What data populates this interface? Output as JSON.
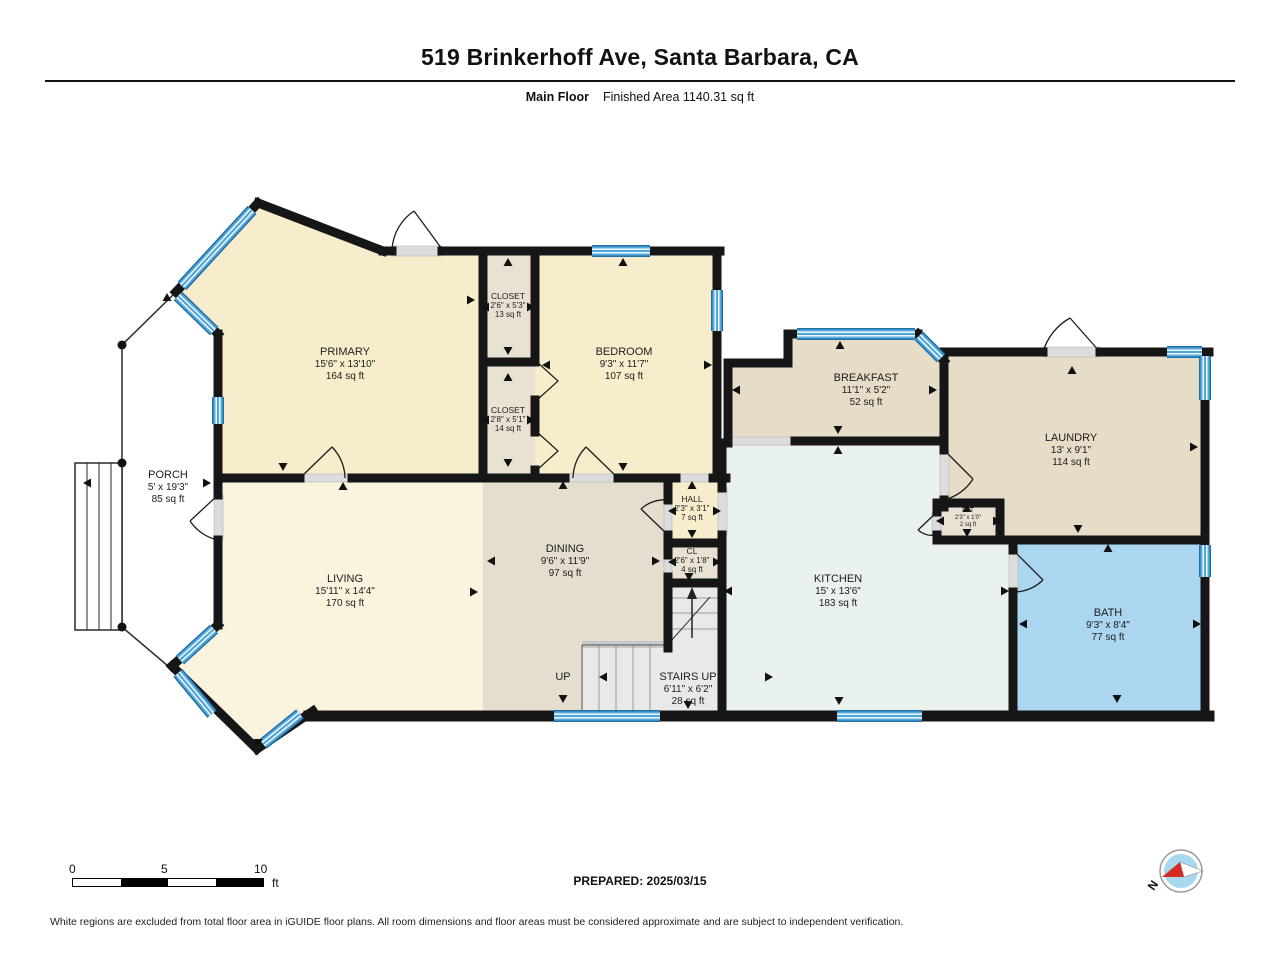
{
  "header": {
    "title": "519 Brinkerhoff Ave, Santa Barbara, CA",
    "floor_label": "Main Floor",
    "area_label": "Finished Area 1140.31 sq ft"
  },
  "rooms": {
    "primary": {
      "name": "PRIMARY",
      "dims": "15'6\" x 13'10\"",
      "area": "164 sq ft"
    },
    "closet1": {
      "name": "CLOSET",
      "dims": "2'6\" x 5'3\"",
      "area": "13 sq ft"
    },
    "closet2": {
      "name": "CLOSET",
      "dims": "2'8\" x 5'1\"",
      "area": "14 sq ft"
    },
    "bedroom": {
      "name": "BEDROOM",
      "dims": "9'3\" x 11'7\"",
      "area": "107 sq ft"
    },
    "breakfast": {
      "name": "BREAKFAST",
      "dims": "11'1\" x 5'2\"",
      "area": "52 sq ft"
    },
    "laundry": {
      "name": "LAUNDRY",
      "dims": "13' x 9'1\"",
      "area": "114 sq ft"
    },
    "porch": {
      "name": "PORCH",
      "dims": "5' x 19'3\"",
      "area": "85 sq ft"
    },
    "living": {
      "name": "LIVING",
      "dims": "15'11\" x 14'4\"",
      "area": "170 sq ft"
    },
    "dining": {
      "name": "DINING",
      "dims": "9'6\" x 11'9\"",
      "area": "97 sq ft"
    },
    "hall": {
      "name": "HALL",
      "dims": "2'3\" x 3'1\"",
      "area": "7 sq ft"
    },
    "cl": {
      "name": "CL",
      "dims": "2'6\" x 1'8\"",
      "area": "4 sq ft"
    },
    "kitchen": {
      "name": "KITCHEN",
      "dims": "15' x 13'6\"",
      "area": "183 sq ft"
    },
    "bath": {
      "name": "BATH",
      "dims": "9'3\" x 8'4\"",
      "area": "77 sq ft"
    },
    "stairs": {
      "name": "STAIRS UP",
      "dims": "6'11\" x 6'2\"",
      "area": "28 sq ft"
    },
    "pat": {
      "name": "PAT",
      "dims": "2'3\" x 1'0\"",
      "area": "2 sq ft"
    },
    "up_label": "UP"
  },
  "scale_bar": {
    "tick0": "0",
    "tick5": "5",
    "tick10": "10",
    "unit": "ft"
  },
  "footer": {
    "prepared": "PREPARED: 2025/03/15",
    "disclaimer": "White regions are excluded from total floor area in iGUIDE floor plans. All room dimensions and floor areas must be considered approximate and are subject to independent verification."
  },
  "compass": {
    "north_label": "N"
  },
  "colors": {
    "wall": "#161616",
    "window_blue": "#4ea6da",
    "cream": "#f7edcc",
    "living_cream": "#faf3dd",
    "dining_tan": "#e5decf",
    "tan": "#e7dcc7",
    "kitchen_mint": "#e9f2ec",
    "bath_blue": "#abd6ef",
    "closet_gray": "#e9e2d3",
    "stairs_gray": "#e9e9e9",
    "porch_white": "#ffffff",
    "compass_blue": "#a8d8f0",
    "compass_red": "#d42a20"
  }
}
